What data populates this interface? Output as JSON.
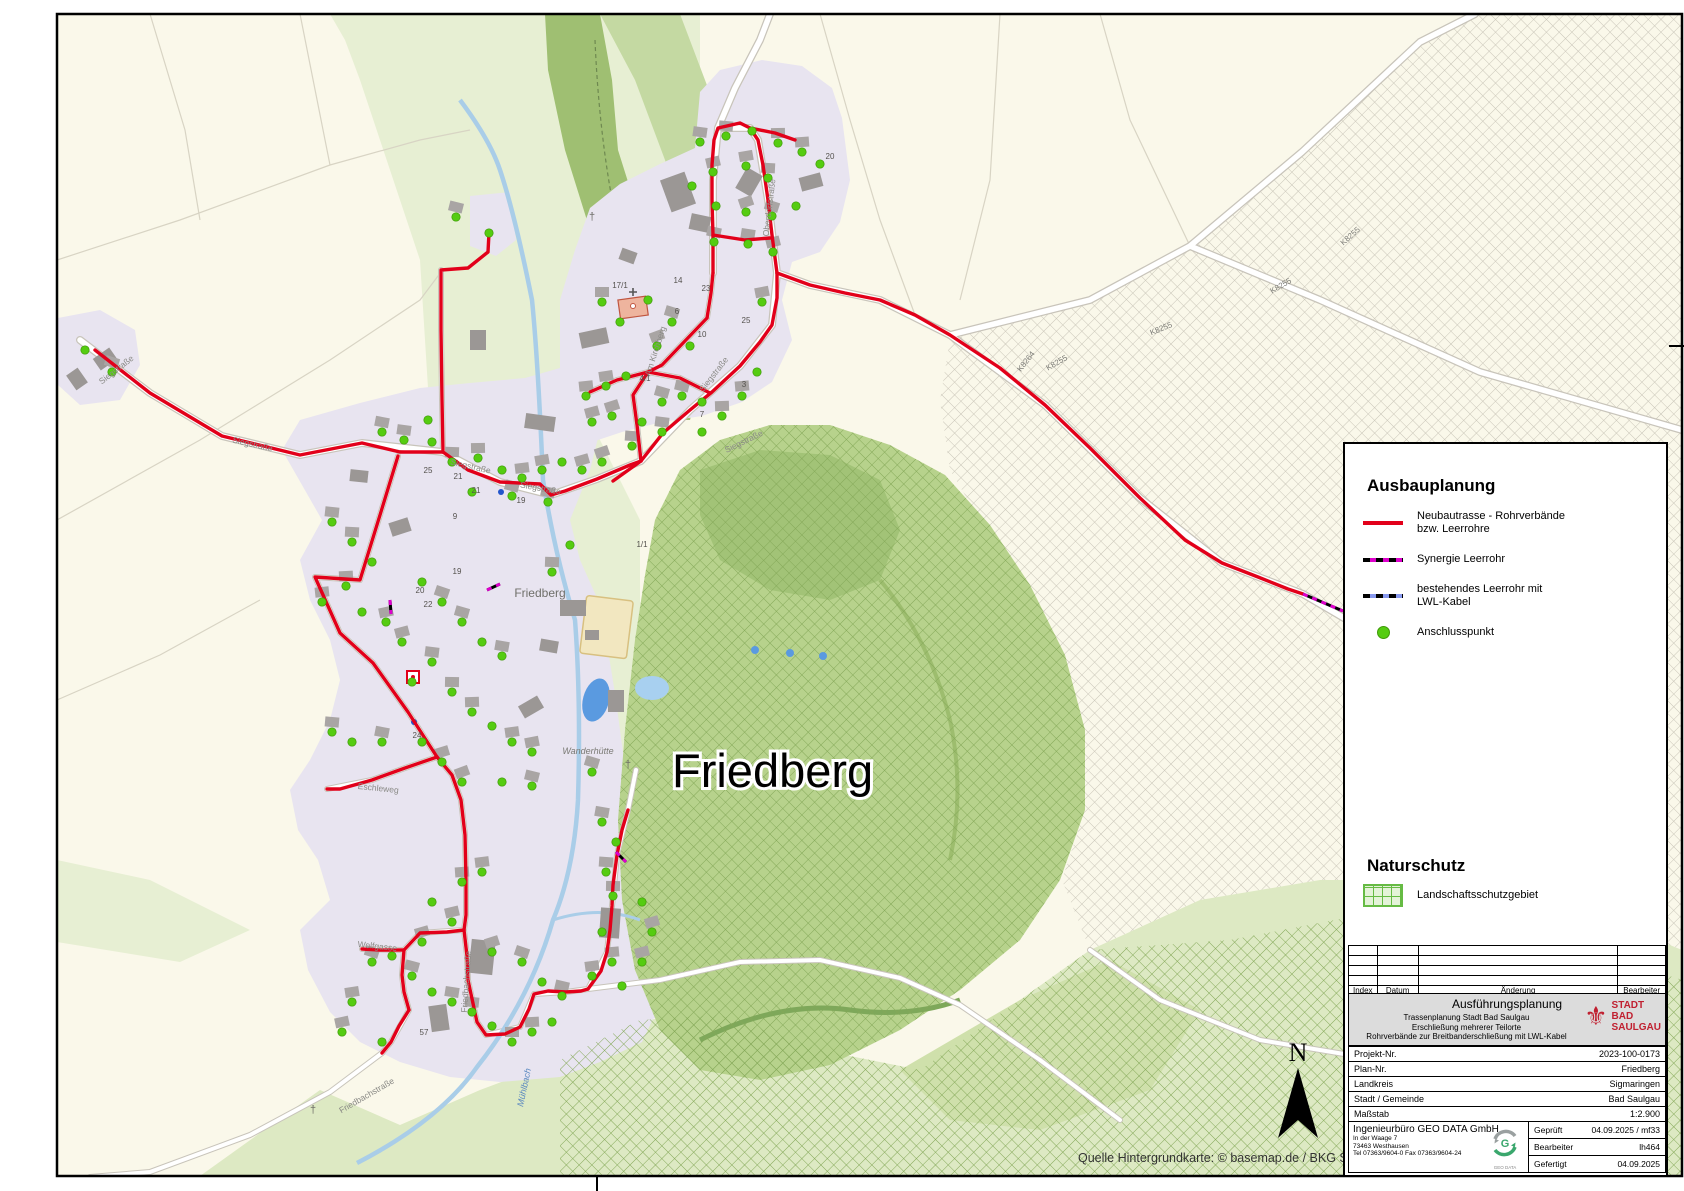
{
  "map": {
    "big_label": "Friedberg",
    "attribution": "Quelle Hintergrundkarte: © basemap.de / BKG Sep 2025",
    "north_label": "N",
    "street_labels": [
      {
        "text": "Siegstraße",
        "x": 118,
        "y": 372,
        "r": -38
      },
      {
        "text": "Siegstraße",
        "x": 252,
        "y": 447,
        "r": 13
      },
      {
        "text": "Siegstraße",
        "x": 470,
        "y": 469,
        "r": 13
      },
      {
        "text": "Siegstraße",
        "x": 540,
        "y": 491,
        "r": 10
      },
      {
        "text": "Siegstraße",
        "x": 716,
        "y": 376,
        "r": -52
      },
      {
        "text": "Siegstraße",
        "x": 745,
        "y": 444,
        "r": -26
      },
      {
        "text": "Oberdorfstraße",
        "x": 772,
        "y": 208,
        "r": -83
      },
      {
        "text": "Am Kirchberg",
        "x": 658,
        "y": 352,
        "r": -72
      },
      {
        "text": "Eschleweg",
        "x": 378,
        "y": 791,
        "r": 6
      },
      {
        "text": "Friedbachstraße",
        "x": 469,
        "y": 982,
        "r": -86
      },
      {
        "text": "Friedbachstraße",
        "x": 368,
        "y": 1098,
        "r": -30
      },
      {
        "text": "Wolfgasse",
        "x": 377,
        "y": 949,
        "r": 6
      }
    ],
    "road_labels": [
      {
        "text": "K8255",
        "x": 1162,
        "y": 331,
        "r": -22
      },
      {
        "text": "K8255",
        "x": 1058,
        "y": 365,
        "r": -30
      },
      {
        "text": "K8255",
        "x": 1282,
        "y": 288,
        "r": -30
      },
      {
        "text": "K8255",
        "x": 1352,
        "y": 238,
        "r": -42
      },
      {
        "text": "K8264",
        "x": 1028,
        "y": 363,
        "r": -52
      }
    ],
    "house_numbers": [
      {
        "text": "25",
        "x": 428,
        "y": 473
      },
      {
        "text": "21",
        "x": 458,
        "y": 479
      },
      {
        "text": "21",
        "x": 476,
        "y": 493
      },
      {
        "text": "19",
        "x": 521,
        "y": 503
      },
      {
        "text": "9",
        "x": 455,
        "y": 519
      },
      {
        "text": "19",
        "x": 457,
        "y": 574
      },
      {
        "text": "20",
        "x": 420,
        "y": 593
      },
      {
        "text": "22",
        "x": 428,
        "y": 607
      },
      {
        "text": "24",
        "x": 417,
        "y": 738
      },
      {
        "text": "57",
        "x": 424,
        "y": 1035
      },
      {
        "text": "1/1",
        "x": 642,
        "y": 547
      },
      {
        "text": "14",
        "x": 678,
        "y": 283
      },
      {
        "text": "23",
        "x": 706,
        "y": 291
      },
      {
        "text": "25",
        "x": 746,
        "y": 323
      },
      {
        "text": "6",
        "x": 677,
        "y": 314
      },
      {
        "text": "10",
        "x": 702,
        "y": 337
      },
      {
        "text": "20",
        "x": 830,
        "y": 159
      },
      {
        "text": "4/1",
        "x": 645,
        "y": 381
      },
      {
        "text": "3",
        "x": 744,
        "y": 387
      },
      {
        "text": "7",
        "x": 702,
        "y": 417
      },
      {
        "text": "17/1",
        "x": 620,
        "y": 288
      }
    ],
    "poi_labels": [
      {
        "text": "Friedberg",
        "x": 540,
        "y": 597,
        "r": 0,
        "kind": "village"
      },
      {
        "text": "Wanderhütte",
        "x": 588,
        "y": 754,
        "r": 0,
        "kind": "hut"
      },
      {
        "text": "Mühlbach",
        "x": 527,
        "y": 1088,
        "r": -78,
        "kind": "water"
      }
    ]
  },
  "legend": {
    "title": "Ausbauplanung",
    "items": [
      {
        "label": "Neubautrasse - Rohrverbände bzw. Leerrohre"
      },
      {
        "label": "Synergie Leerrohr"
      },
      {
        "label": "bestehendes Leerrohr mit LWL-Kabel"
      },
      {
        "label": "Anschlusspunkt"
      }
    ],
    "nature_title": "Naturschutz",
    "nature_item": "Landschaftsschutzgebiet"
  },
  "titleblock": {
    "rev_headers": [
      "Index",
      "Datum",
      "Änderung",
      "Bearbeiter"
    ],
    "plan_type": "Ausführungsplanung",
    "subtitle_lines": [
      "Trassenplanung Stadt Bad Saulgau",
      "Erschließung mehrerer Teilorte",
      "Rohrverbände zur Breitbanderschließung mit LWL-Kabel"
    ],
    "city_logo_lines": [
      "STADT",
      "BAD",
      "SAULGAU"
    ],
    "rows": [
      {
        "label": "Projekt-Nr.",
        "value": "2023-100-0173"
      },
      {
        "label": "Plan-Nr.",
        "value": "Friedberg"
      },
      {
        "label": "Landkreis",
        "value": "Sigmaringen"
      },
      {
        "label": "Stadt / Gemeinde",
        "value": "Bad Saulgau"
      },
      {
        "label": "Maßstab",
        "value": "1:2.900"
      }
    ],
    "company": {
      "name": "Ingenieurbüro GEO DATA GmbH",
      "address_lines": [
        "In der Waage 7",
        "73463 Westhausen",
        "Tel 07363/9604-0   Fax 07363/9604-24"
      ],
      "logo_text": "GEO DATA"
    },
    "approval_rows": [
      {
        "label": "Geprüft",
        "value": "04.09.2025 / mf33"
      },
      {
        "label": "Bearbeiter",
        "value": "lh464"
      },
      {
        "label": "Gefertigt",
        "value": "04.09.2025"
      }
    ]
  },
  "colors": {
    "route_red": "#e2001a",
    "synergie_magenta": "#dd00cc",
    "lwl_blue": "#8899ee",
    "connection_green": "#55cc11",
    "nature_green": "#66bb44",
    "city_red": "#c02030"
  }
}
